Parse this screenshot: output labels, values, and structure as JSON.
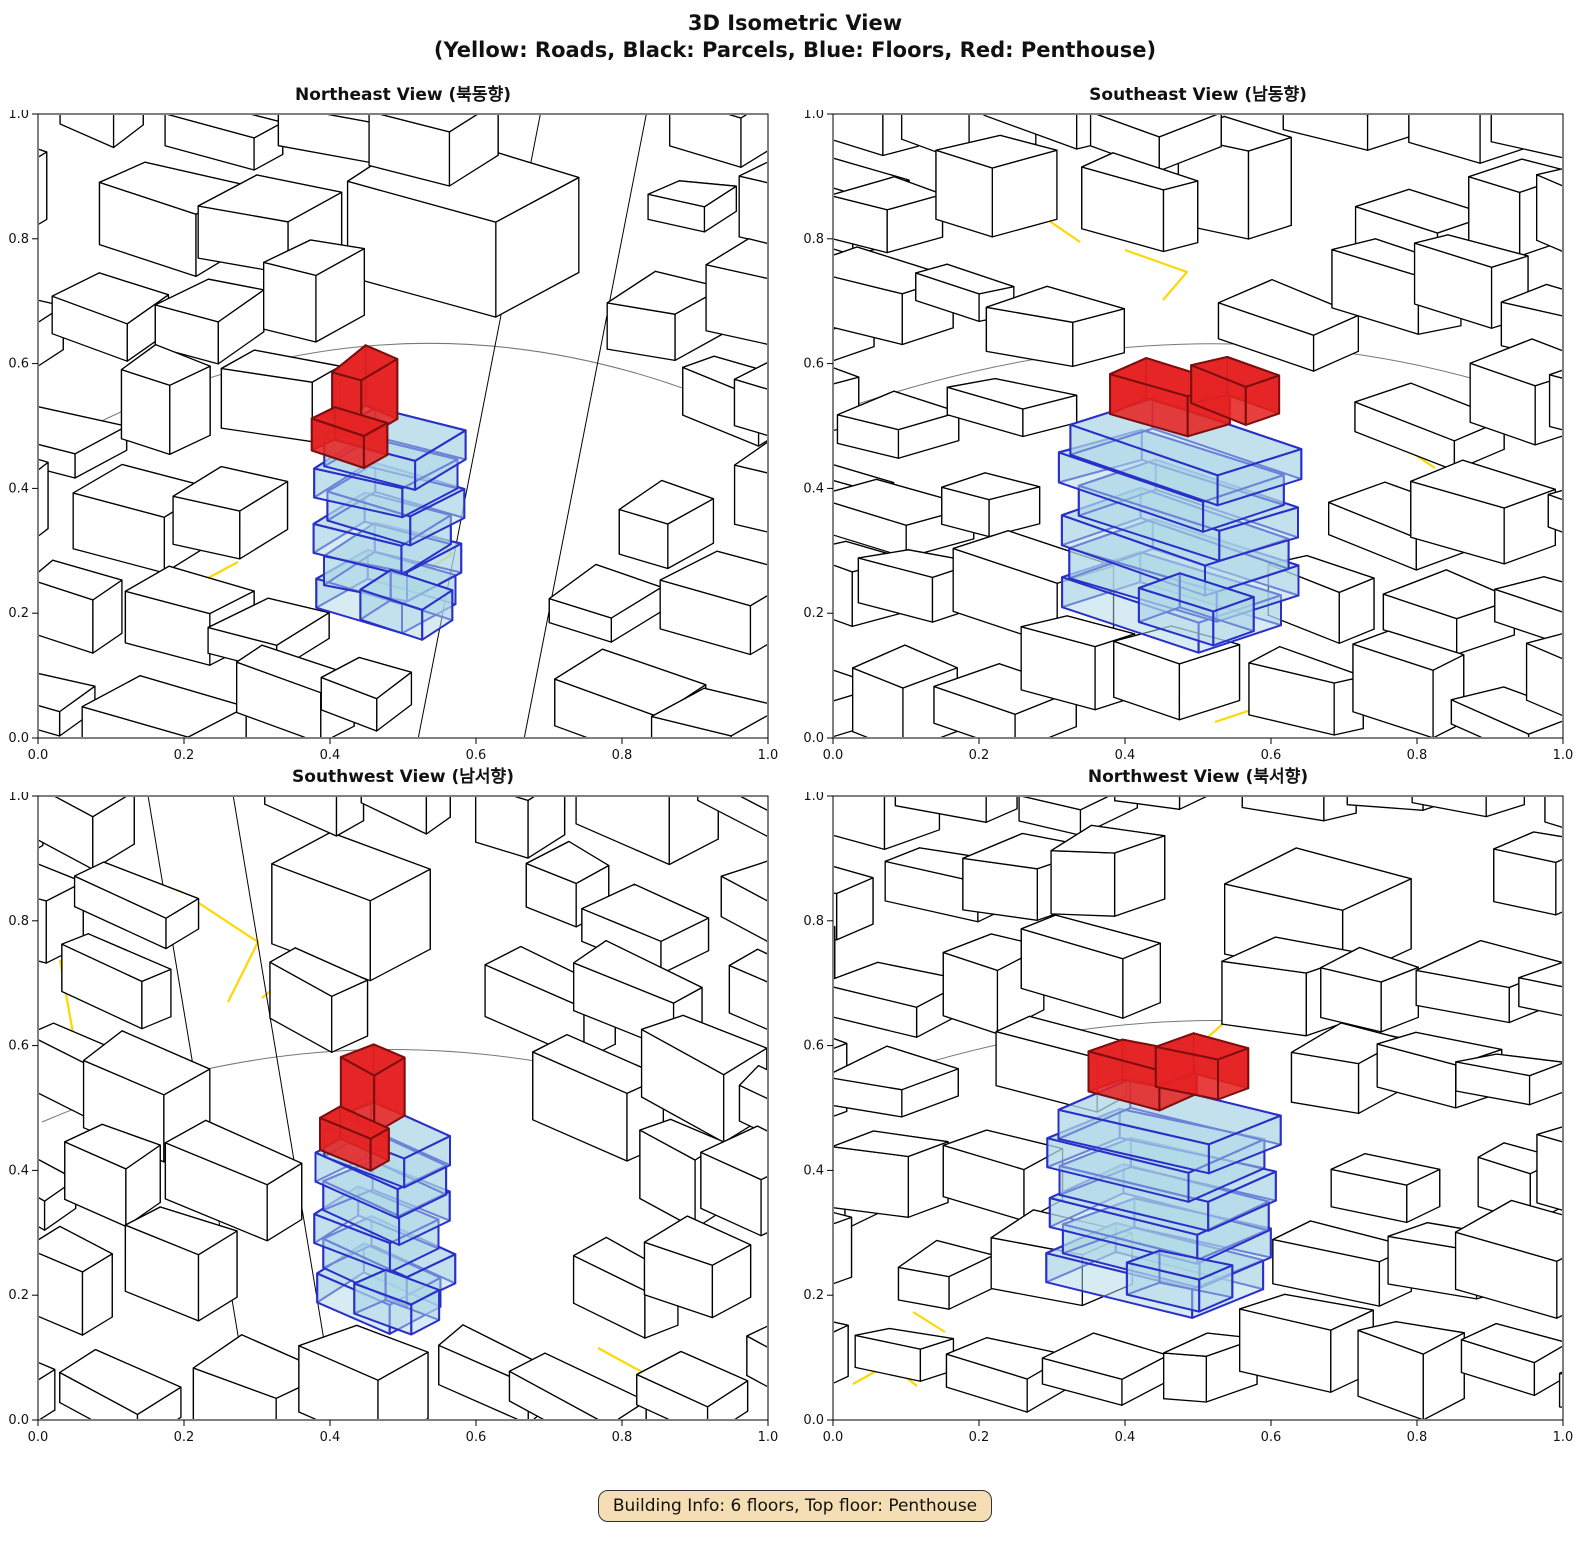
{
  "title": {
    "line1": "3D Isometric View",
    "line2": "(Yellow: Roads, Black: Parcels, Blue: Floors, Red: Penthouse)"
  },
  "legend": {
    "roads": "Yellow",
    "parcels": "Black",
    "floors": "Blue",
    "penthouse": "Red"
  },
  "subplots": [
    {
      "id": "northeast",
      "title": "Northeast View (북동향)"
    },
    {
      "id": "southeast",
      "title": "Southeast View (남동향)"
    },
    {
      "id": "southwest",
      "title": "Southwest View (남서향)"
    },
    {
      "id": "northwest",
      "title": "Northwest View (북서향)"
    }
  ],
  "axis_ticks": {
    "x": [
      "0.0",
      "0.2",
      "0.4",
      "0.6",
      "0.8",
      "1.0"
    ],
    "y": [
      "0.0",
      "0.2",
      "0.4",
      "0.6",
      "0.8",
      "1.0"
    ],
    "x_range": [
      0.0,
      1.0
    ],
    "y_range": [
      0.0,
      1.0
    ]
  },
  "footer": {
    "text": "Building Info: 6 floors, Top floor: Penthouse"
  },
  "building_info": {
    "floors": 6,
    "top_floor": "Penthouse"
  },
  "colors": {
    "background": "#ffffff",
    "parcel_edge": "#000000",
    "parcel_fill": "#ffffff",
    "road": "#FFD700",
    "floor_edge": "#2A2FC9",
    "floor_fill": "#ADD8E6",
    "penthouse_fill": "#E52323",
    "penthouse_edge": "#7E0E0E",
    "boundary": "#777777",
    "axis": "#000000",
    "tick_label": "#111111",
    "footer_bg": "#F5DEB3",
    "footer_border": "#333333",
    "footer_text": "#111111"
  }
}
